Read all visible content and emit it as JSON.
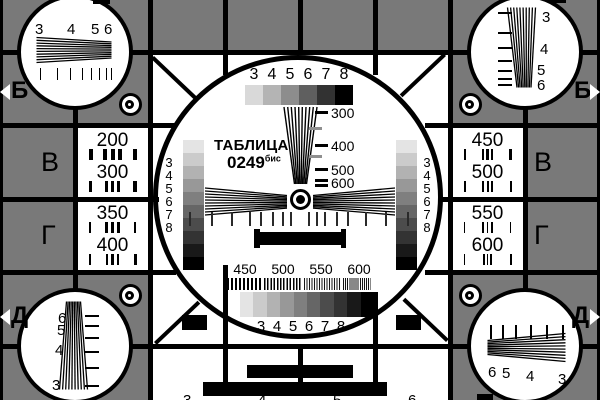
{
  "card": {
    "title": "ТАБЛИЦА",
    "number": "0249",
    "number_suffix": "бис"
  },
  "colors": {
    "background_gray": "#797979",
    "grid_black": "#000000",
    "panel_white": "#ffffff"
  },
  "row_markers": {
    "top_left": "Б",
    "top_right": "Б",
    "bottom_left": "Д",
    "bottom_right": "Д"
  },
  "column_letters": {
    "left_upper": "В",
    "left_lower": "Г",
    "right_upper": "В",
    "right_lower": "Г"
  },
  "edge_digits": {
    "top": [
      "3",
      "4",
      "5",
      "6"
    ],
    "bottom": [
      "3",
      "4",
      "5",
      "6"
    ]
  },
  "center_circle": {
    "top_scale_labels": [
      "3",
      "4",
      "5",
      "6",
      "7",
      "8"
    ],
    "top_grayscale_steps": [
      "#d9d9d9",
      "#b4b4b4",
      "#8d8d8d",
      "#5f5f5f",
      "#323232",
      "#000000"
    ],
    "wedge_scale_labels": [
      "300",
      "400",
      "500",
      "600"
    ],
    "left_scale_labels": [
      "3",
      "4",
      "5",
      "6",
      "7",
      "8"
    ],
    "right_scale_labels": [
      "3",
      "4",
      "5",
      "6",
      "7",
      "8"
    ],
    "side_grayscale_steps": [
      "#e4e4e4",
      "#cbcbcb",
      "#b2b2b2",
      "#989898",
      "#7f7f7f",
      "#666666",
      "#4c4c4c",
      "#333333",
      "#191919",
      "#000000"
    ],
    "bottom_freq_labels": [
      "450",
      "500",
      "550",
      "600"
    ],
    "bottom_grayscale_steps": [
      "#e4e4e4",
      "#cbcbcb",
      "#b2b2b2",
      "#989898",
      "#7f7f7f",
      "#666666",
      "#4c4c4c",
      "#333333",
      "#191919",
      "#000000"
    ],
    "bottom_scale_labels": [
      "3",
      "4",
      "5",
      "6",
      "7",
      "8"
    ]
  },
  "resolution_boxes": {
    "left_top": [
      "200",
      "300"
    ],
    "left_bottom": [
      "350",
      "400"
    ],
    "right_top": [
      "450",
      "500"
    ],
    "right_bottom": [
      "550",
      "600"
    ]
  },
  "corner_circles": {
    "top_left_labels": [
      "3",
      "4",
      "5",
      "6"
    ],
    "top_right_labels": [
      "3",
      "4",
      "5",
      "6"
    ],
    "bottom_left_labels": [
      "6",
      "5",
      "4",
      "3"
    ],
    "bottom_right_labels": [
      "6",
      "5",
      "4",
      "3"
    ]
  }
}
